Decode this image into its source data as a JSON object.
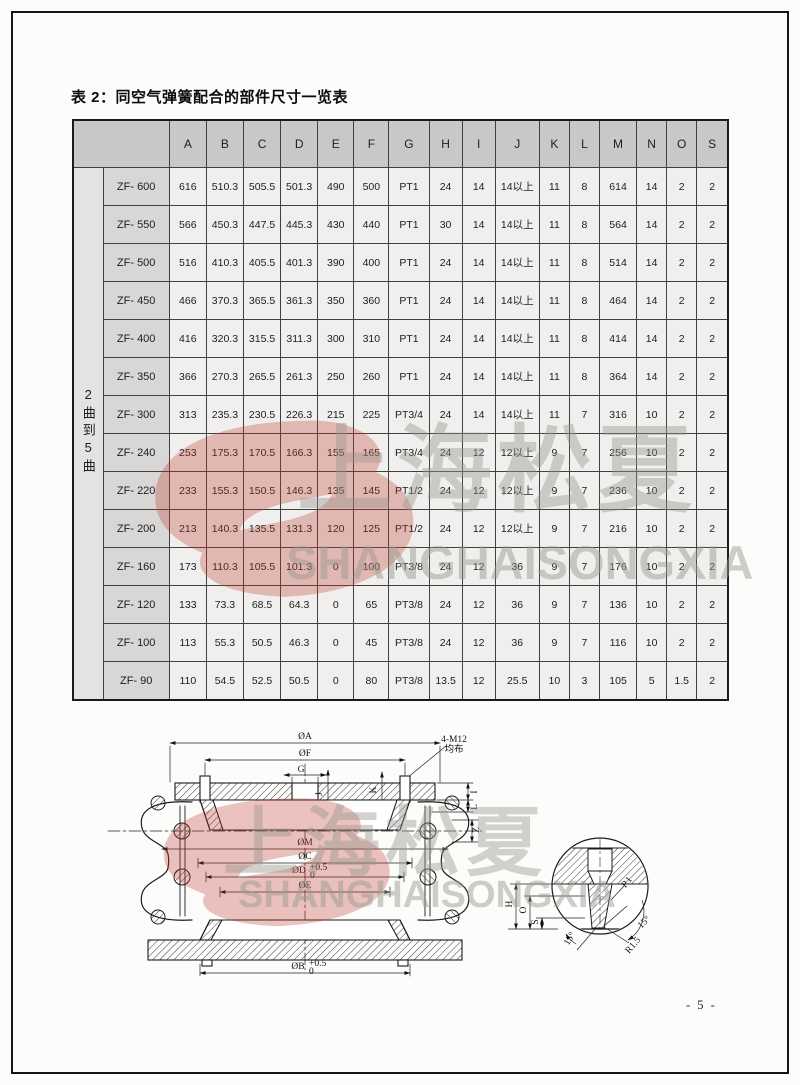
{
  "page": {
    "title": "表 2：同空气弹簧配合的部件尺寸一览表",
    "page_number": "- 5 -"
  },
  "watermark": {
    "cn": "上海松夏",
    "en": "SHANGHAISONGXIA",
    "logo_color": "#c0392b"
  },
  "table": {
    "group_label": "2曲到5曲",
    "columns": [
      "A",
      "B",
      "C",
      "D",
      "E",
      "F",
      "G",
      "H",
      "I",
      "J",
      "K",
      "L",
      "M",
      "N",
      "O",
      "S"
    ],
    "rows": [
      {
        "model": "ZF- 600",
        "values": [
          "616",
          "510.3",
          "505.5",
          "501.3",
          "490",
          "500",
          "PT1",
          "24",
          "14",
          "14以上",
          "11",
          "8",
          "614",
          "14",
          "2",
          "2"
        ]
      },
      {
        "model": "ZF- 550",
        "values": [
          "566",
          "450.3",
          "447.5",
          "445.3",
          "430",
          "440",
          "PT1",
          "30",
          "14",
          "14以上",
          "11",
          "8",
          "564",
          "14",
          "2",
          "2"
        ]
      },
      {
        "model": "ZF- 500",
        "values": [
          "516",
          "410.3",
          "405.5",
          "401.3",
          "390",
          "400",
          "PT1",
          "24",
          "14",
          "14以上",
          "11",
          "8",
          "514",
          "14",
          "2",
          "2"
        ]
      },
      {
        "model": "ZF- 450",
        "values": [
          "466",
          "370.3",
          "365.5",
          "361.3",
          "350",
          "360",
          "PT1",
          "24",
          "14",
          "14以上",
          "11",
          "8",
          "464",
          "14",
          "2",
          "2"
        ]
      },
      {
        "model": "ZF- 400",
        "values": [
          "416",
          "320.3",
          "315.5",
          "311.3",
          "300",
          "310",
          "PT1",
          "24",
          "14",
          "14以上",
          "11",
          "8",
          "414",
          "14",
          "2",
          "2"
        ]
      },
      {
        "model": "ZF- 350",
        "values": [
          "366",
          "270.3",
          "265.5",
          "261.3",
          "250",
          "260",
          "PT1",
          "24",
          "14",
          "14以上",
          "11",
          "8",
          "364",
          "14",
          "2",
          "2"
        ]
      },
      {
        "model": "ZF- 300",
        "values": [
          "313",
          "235.3",
          "230.5",
          "226.3",
          "215",
          "225",
          "PT3/4",
          "24",
          "14",
          "14以上",
          "11",
          "7",
          "316",
          "10",
          "2",
          "2"
        ]
      },
      {
        "model": "ZF- 240",
        "values": [
          "253",
          "175.3",
          "170.5",
          "166.3",
          "155",
          "165",
          "PT3/4",
          "24",
          "12",
          "12以上",
          "9",
          "7",
          "256",
          "10",
          "2",
          "2"
        ]
      },
      {
        "model": "ZF- 220",
        "values": [
          "233",
          "155.3",
          "150.5",
          "146.3",
          "135",
          "145",
          "PT1/2",
          "24",
          "12",
          "12以上",
          "9",
          "7",
          "236",
          "10",
          "2",
          "2"
        ]
      },
      {
        "model": "ZF- 200",
        "values": [
          "213",
          "140.3",
          "135.5",
          "131.3",
          "120",
          "125",
          "PT1/2",
          "24",
          "12",
          "12以上",
          "9",
          "7",
          "216",
          "10",
          "2",
          "2"
        ]
      },
      {
        "model": "ZF- 160",
        "values": [
          "173",
          "110.3",
          "105.5",
          "101.3",
          "0",
          "100",
          "PT3/8",
          "24",
          "12",
          "36",
          "9",
          "7",
          "176",
          "10",
          "2",
          "2"
        ]
      },
      {
        "model": "ZF- 120",
        "values": [
          "133",
          "73.3",
          "68.5",
          "64.3",
          "0",
          "65",
          "PT3/8",
          "24",
          "12",
          "36",
          "9",
          "7",
          "136",
          "10",
          "2",
          "2"
        ]
      },
      {
        "model": "ZF- 100",
        "values": [
          "113",
          "55.3",
          "50.5",
          "46.3",
          "0",
          "45",
          "PT3/8",
          "24",
          "12",
          "36",
          "9",
          "7",
          "116",
          "10",
          "2",
          "2"
        ]
      },
      {
        "model": "ZF- 90",
        "values": [
          "110",
          "54.5",
          "52.5",
          "50.5",
          "0",
          "80",
          "PT3/8",
          "13.5",
          "12",
          "25.5",
          "10",
          "3",
          "105",
          "5",
          "1.5",
          "2"
        ]
      }
    ]
  },
  "diagram": {
    "dim_a": "ØA",
    "dim_f": "ØF",
    "dim_g": "G",
    "bolt_note_line1": "4-M12",
    "bolt_note_line2": "均布",
    "dim_i": "I",
    "dim_l": "L",
    "dim_j": "J",
    "dim_k": "K",
    "dim_z": "Z",
    "dim_m": "ØM",
    "dim_c": "ØC",
    "dim_d": "ØD",
    "dim_d_sup": "+0.5",
    "dim_d_sub": "0",
    "dim_e": "ØE",
    "dim_b": "ØB",
    "dim_b_sup": "+0.5",
    "dim_b_sub": "0",
    "detail_h": "H",
    "detail_o": "O",
    "detail_s": "S",
    "detail_r1": "R1",
    "detail_r15": "R1.5",
    "detail_angle1": "15°",
    "detail_angle2": "15°"
  }
}
